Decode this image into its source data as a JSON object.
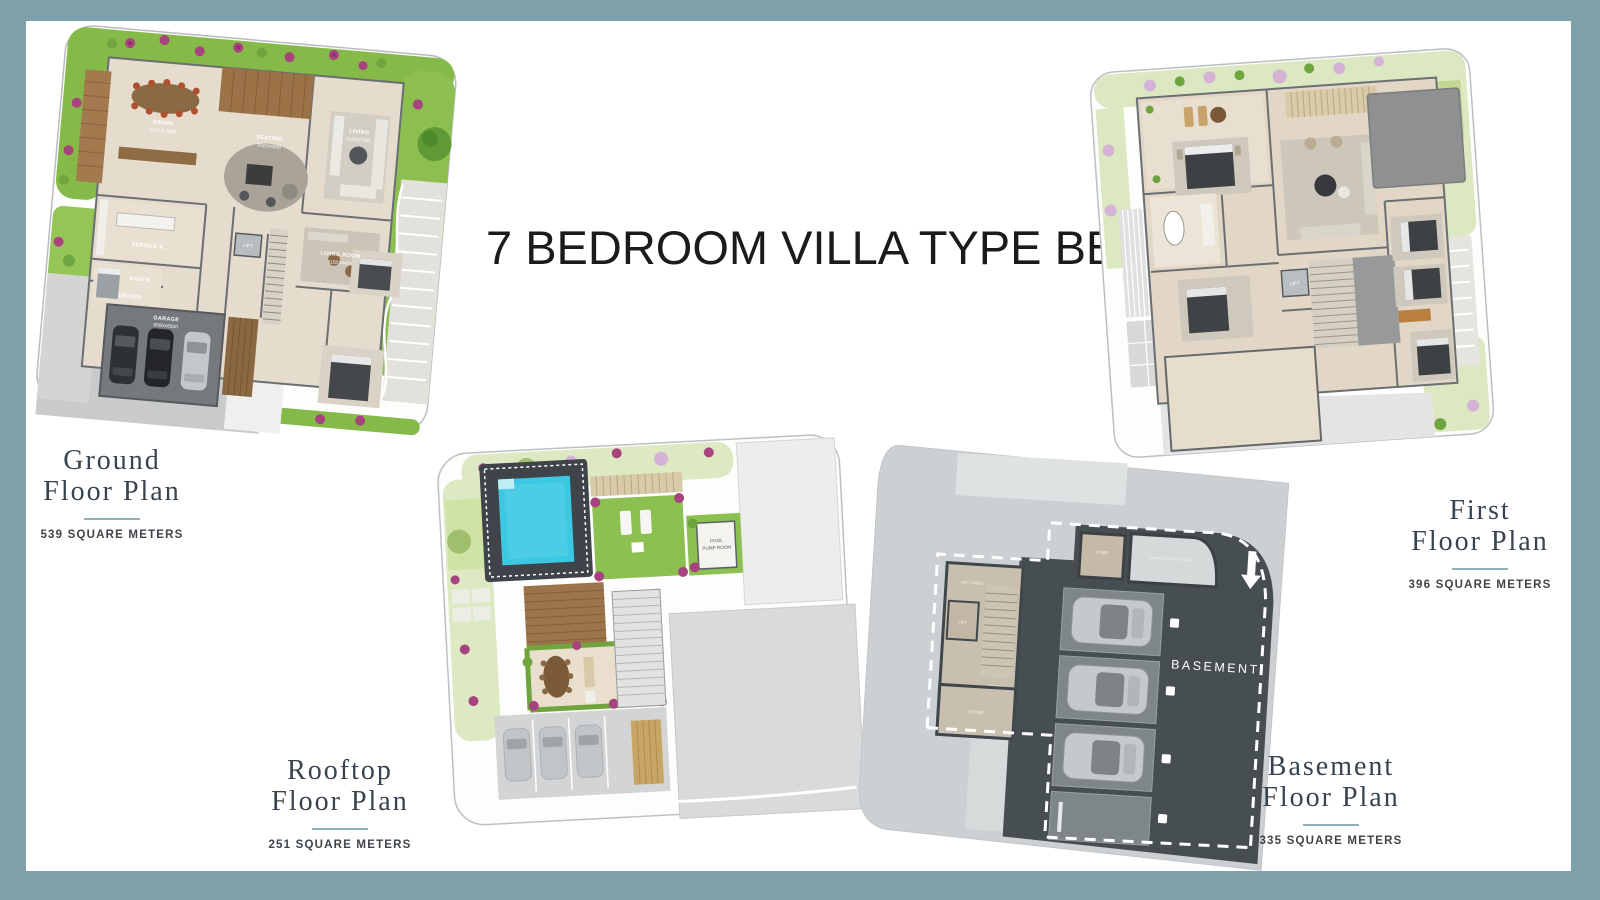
{
  "page": {
    "title": "7 BEDROOM VILLA TYPE BB"
  },
  "plans": {
    "ground": {
      "line1": "Ground",
      "line2": "Floor Plan",
      "area": "539 SQUARE METERS"
    },
    "first": {
      "line1": "First",
      "line2": "Floor Plan",
      "area": "396 SQUARE METERS"
    },
    "rooftop": {
      "line1": "Rooftop",
      "line2": "Floor Plan",
      "area": "251 SQUARE METERS"
    },
    "basement": {
      "line1": "Basement",
      "line2": "Floor Plan",
      "area": "335 SQUARE METERS"
    }
  },
  "room_labels": {
    "ground": {
      "dining": "DINING",
      "dining_dims": "4310 X 7800",
      "seating": "SEATING",
      "seating_dims": "7610X4500",
      "living": "LIVING",
      "living_dims": "6100X7285",
      "living_room": "LIVING ROOM",
      "living_room_dims": "8150X4400",
      "service_kitchen": "SERVICE K.",
      "maids": "MAID'S",
      "driver": "DRIVER",
      "lift": "LIFT",
      "garage": "GARAGE",
      "garage_dims": "9000X6500"
    },
    "first": {
      "lift": "LIFT"
    },
    "rooftop": {
      "pool_pump_line1": "POOL",
      "pool_pump_line2": "PUMP ROOM"
    },
    "basement": {
      "zone": "BASEMENT",
      "pump": "PUMP",
      "tank": "DOMESTIC WATER TANK",
      "lift_lobby": "LIFT LOBBY",
      "lift": "LIFT",
      "stairs": "STAIRS",
      "store": "STORE"
    }
  },
  "colors": {
    "frame": "#7FA1A9",
    "title_text": "#1B1B1B",
    "heading_text": "#39434F",
    "divider": "#8FAFB5",
    "area_text": "#3F4449",
    "flower": "#A8437F",
    "pool_water": "#3CC7E2",
    "lawn": "#8CC152",
    "basement_dark": "#474E52"
  }
}
